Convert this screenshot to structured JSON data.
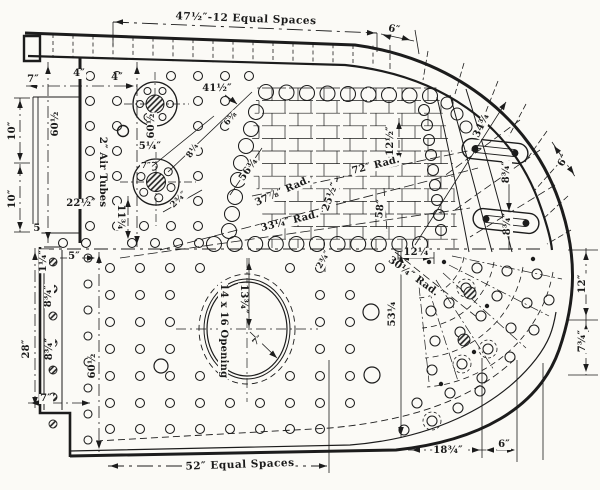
{
  "title": "Boiler side sheet working drawing",
  "colors": {
    "ink": "#1c1c1c",
    "paper": "#fbfaf6"
  },
  "labels": {
    "top_span": "47½″-12 Equal Spaces",
    "top_6": "6″",
    "seven_top": "7″",
    "four_a": "4″",
    "four_b": "4″",
    "d41h": "41½″",
    "d6e": "6⅝",
    "d8q": "8¼",
    "d5q": "5¼″",
    "air_tubes": "2″ Air Tubes",
    "d60h_a": "60½",
    "d60h_b": "60½",
    "ten_a": "10″",
    "ten_b": "10″",
    "five_a": "5",
    "d22h": "22½″",
    "d11t": "11¾",
    "d2t_a": "2¾″",
    "seven_flange": "7″",
    "d56t": "56¾",
    "rad37": "37⅞″ Rad.",
    "rad33": "33¼″ Rad.",
    "rad72": "72″ Rad.",
    "d25h": "25½″",
    "d58": "58″",
    "d12h": "12½″",
    "d34t": "34¾",
    "d8t_a": "8¾″",
    "d8t_b": "8¾″",
    "six_right": "6″",
    "d12q": "12¼",
    "rad30": "30¼″ Rad.",
    "d2t_b": "2¾″",
    "d53q": "53¼",
    "d13t": "13¾″",
    "opening": "14 x 16 Opening",
    "seven_open": "7″",
    "d1q": "1¼″",
    "d8t_c": "8¾″",
    "d8t_d": "8¾″",
    "d28": "28″",
    "five_b": "5″",
    "d60h_c": "60½",
    "seven_bot": "7″",
    "bottom_span": "52″ Equal Spaces",
    "d18t": "18¾″",
    "six_bottom": "6″",
    "d12r": "12″",
    "d7t": "7¾″"
  }
}
